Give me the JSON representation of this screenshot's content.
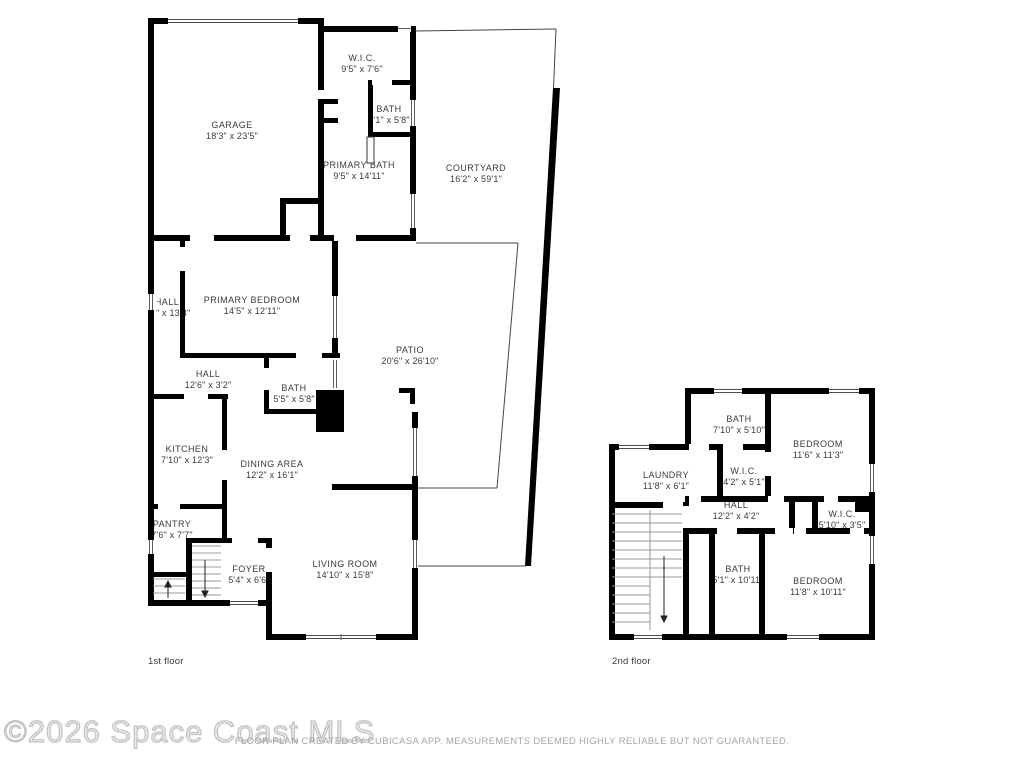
{
  "watermark": "©2026 Space Coast MLS",
  "disclaimer": "FLOOR PLAN CREATED BY CUBICASA APP. MEASUREMENTS DEEMED HIGHLY RELIABLE BUT NOT GUARANTEED.",
  "colors": {
    "wall": "#000000",
    "label_text": "#3a3a3a",
    "thin_line": "#444444",
    "stair_line": "#999999",
    "watermark_gray": "#c3c3c3",
    "disclaimer_gray": "#a5a5a6"
  },
  "floors": [
    {
      "caption": "1st floor",
      "rooms": [
        {
          "name": "GARAGE",
          "dims": "18'3\" x 23'5\""
        },
        {
          "name": "W.I.C.",
          "dims": "9'5\" x 7'6\""
        },
        {
          "name": "BATH",
          "dims": "4'1\" x 5'8\""
        },
        {
          "name": "PRIMARY BATH",
          "dims": "9'5\" x 14'11\""
        },
        {
          "name": "COURTYARD",
          "dims": "16'2\" x 59'1\""
        },
        {
          "name": "PRIMARY BEDROOM",
          "dims": "14'5\" x 12'11\""
        },
        {
          "name": "HALL",
          "dims": "3'6\" x 13'3\""
        },
        {
          "name": "HALL",
          "dims": "12'6\" x 3'2\""
        },
        {
          "name": "BATH",
          "dims": "5'5\" x 5'8\""
        },
        {
          "name": "PATIO",
          "dims": "20'6\" x 26'10\""
        },
        {
          "name": "KITCHEN",
          "dims": "7'10\" x 12'3\""
        },
        {
          "name": "DINING AREA",
          "dims": "12'2\" x 16'1\""
        },
        {
          "name": "PANTRY",
          "dims": "7'6\" x 7'7\""
        },
        {
          "name": "FOYER",
          "dims": "5'4\" x 6'6\""
        },
        {
          "name": "LIVING ROOM",
          "dims": "14'10\" x 15'8\""
        }
      ]
    },
    {
      "caption": "2nd floor",
      "rooms": [
        {
          "name": "BATH",
          "dims": "7'10\" x 5'10\""
        },
        {
          "name": "BEDROOM",
          "dims": "11'6\" x 11'3\""
        },
        {
          "name": "LAUNDRY",
          "dims": "11'8\" x 6'1\""
        },
        {
          "name": "W.I.C.",
          "dims": "4'2\" x 5'1\""
        },
        {
          "name": "HALL",
          "dims": "12'2\" x 4'2\""
        },
        {
          "name": "W.I.C.",
          "dims": "5'10\" x 3'5\""
        },
        {
          "name": "BATH",
          "dims": "5'1\" x 10'11\""
        },
        {
          "name": "BEDROOM",
          "dims": "11'8\" x 10'11\""
        }
      ]
    }
  ]
}
